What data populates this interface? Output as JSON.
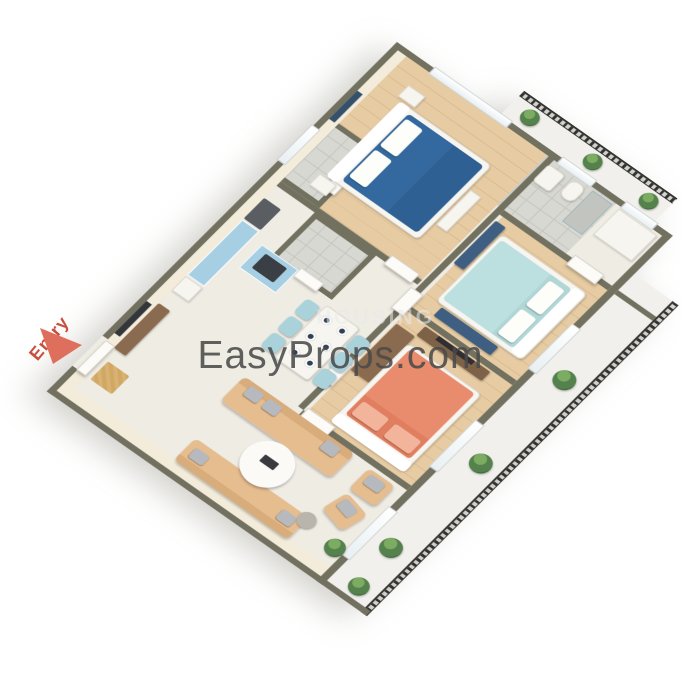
{
  "entry_label": {
    "text": "Entry"
  },
  "watermark": {
    "brand": "EasyProps.com",
    "background_text": "HOUSING"
  },
  "scene": {
    "type": "3d-floor-plan",
    "rooms": [
      "master-bedroom",
      "bedroom-2",
      "bedroom-3",
      "living-room",
      "dining-area",
      "kitchen",
      "bathroom-1",
      "bathroom-2",
      "bathroom-3",
      "balcony-east",
      "balcony-north",
      "entry"
    ]
  },
  "palette": {
    "brand_text": "#4a4a4a",
    "entry_red": "#c8503f",
    "entry_arrow": "#dd6f5c",
    "wall_top": "#72705f",
    "wall_face": "#f3ecdb",
    "floor_cream": "#efece4",
    "floor_wood": "#e4c8a0",
    "floor_tile": "#d8d8d3",
    "bed_blue": "#34699f",
    "bed_teal": "#bcdfdf",
    "bed_coral": "#e98b6d",
    "sofa_tan": "#e6bd8f",
    "kitchen_cabinet_blue": "#a7cfe3",
    "accent_navy": "#3f5f82",
    "railing_dark": "#2f2f2b",
    "plant_green": "#55814d",
    "wood_furniture_brown": "#8a6b4f"
  }
}
